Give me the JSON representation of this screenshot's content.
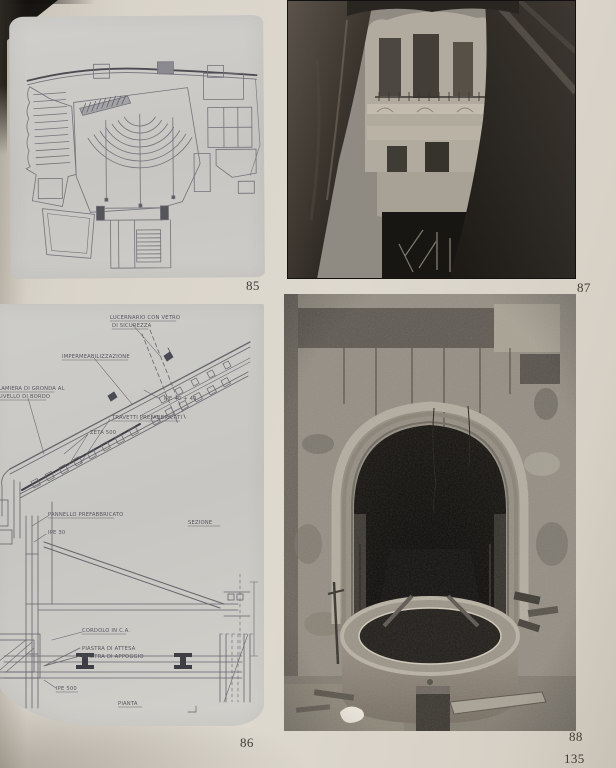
{
  "page": {
    "number": "135"
  },
  "figures": {
    "plan": {
      "caption": "85",
      "alt": "line drawing, theatre floor plan with curved seating rows, stage and side rooms"
    },
    "section": {
      "caption": "86",
      "alt": "construction detail drawing, sloped roof section and plan of steel structure",
      "labels": {
        "skylight1": "LUCERNARIO CON VETRO",
        "skylight2": "DI SICUREZZA",
        "waterproofing": "IMPERMEABILIZZAZIONE",
        "gutter1": "LAMIERA DI GRONDA AL",
        "gutter2": "LIVELLO DI BORDO",
        "profile": "IPE 40 + 40",
        "joists": "TRAVETTI PREFABBRICATI",
        "zeta": "ZETA 500",
        "section": "SEZIONE",
        "panel": "PANNELLO PREFABBRICATO",
        "ipe30": "IPE 30",
        "curb": "CORDOLO IN C.A.",
        "plate1": "PIASTRA DI ATTESA",
        "plate2": "PIASTRA DI APPOGGIO",
        "ipe500": "IPE 500",
        "plan": "PIANTA"
      }
    },
    "courtyard": {
      "caption": "87",
      "alt": "black and white photo, building facade with balconies seen upward through demolished vault"
    },
    "portal": {
      "caption": "88",
      "alt": "black and white photo, stone arched portal with circular concrete basin on rubble ground"
    }
  },
  "colors": {
    "paper": "#d9d4ca",
    "drawing_panel": "#c7c6c2",
    "drawing_ink": "#6a6a72",
    "photo_shadow": "#15130f"
  }
}
